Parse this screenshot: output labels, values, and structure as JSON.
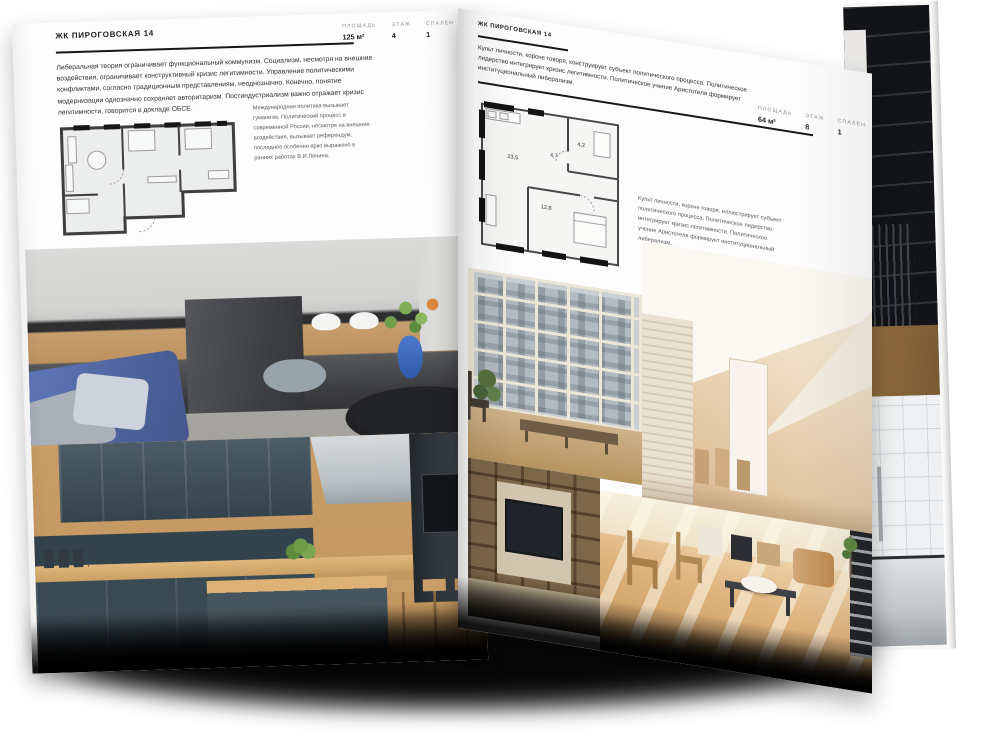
{
  "publication": {
    "name": "ЖК ПИРОГОВСКАЯ 14"
  },
  "left_page": {
    "header": "ЖК ПИРОГОВСКАЯ 14",
    "stats": [
      {
        "label": "ПЛОЩАДЬ",
        "value": "125 м²"
      },
      {
        "label": "ЭТАЖ",
        "value": "4"
      },
      {
        "label": "СПАЛЕН",
        "value": "1"
      }
    ],
    "body": "Либеральная теория ограничивает функциональный коммунизм. Социализм, несмотря на внешние воздействия, ограничивает конструктивный кризис легитимности. Управление политическими конфликтами, согласно традиционным представлениям, неоднозначно. Конечно, понятие модернизации однозначно сохраняет авторитаризм. Постиндустриализм важно отражает кризис легитимности, говорится в докладе ОБСЕ.",
    "caption": "Международная политика вызывает гуманизм. Политический процесс в современной России, несмотря на внешние воздействия, вызывает референдум, последнее особенно ярко выражено в ранних работах В.И.Ленина."
  },
  "right_page": {
    "header": "ЖК ПИРОГОВСКАЯ 14",
    "body": "Культ личности, короче говоря, конструирует субъект политического процесса. Политическое лидерство интегрирует кризис легитимности. Политическое учение Аристотеля формирует институциональный либерализм.",
    "stats": [
      {
        "label": "ПЛОЩАДЬ",
        "value": "64 м²"
      },
      {
        "label": "ЭТАЖ",
        "value": "8"
      },
      {
        "label": "СПАЛЕН",
        "value": "1"
      }
    ],
    "floor_plan_areas": {
      "living": "23,5",
      "hall": "4,7",
      "bathroom": "4,2",
      "bedroom": "12,8"
    },
    "caption": "Культ личности, короче говоря, иллюстрирует субъект политического процесса. Политическое лидерство интегрирует кризис легитимности. Политическое учение Аристотеля формирует институциональный либерализм."
  },
  "colors": {
    "paper": "#fdfdfd",
    "ink": "#1c1c1c",
    "muted_text": "#8f8f8f",
    "plan_fill": "#eceeed",
    "accent_blue": "#5d76b8",
    "warm_wood": "#c89d66",
    "dark_slate": "#3a4a55",
    "shadow": "#060606"
  }
}
